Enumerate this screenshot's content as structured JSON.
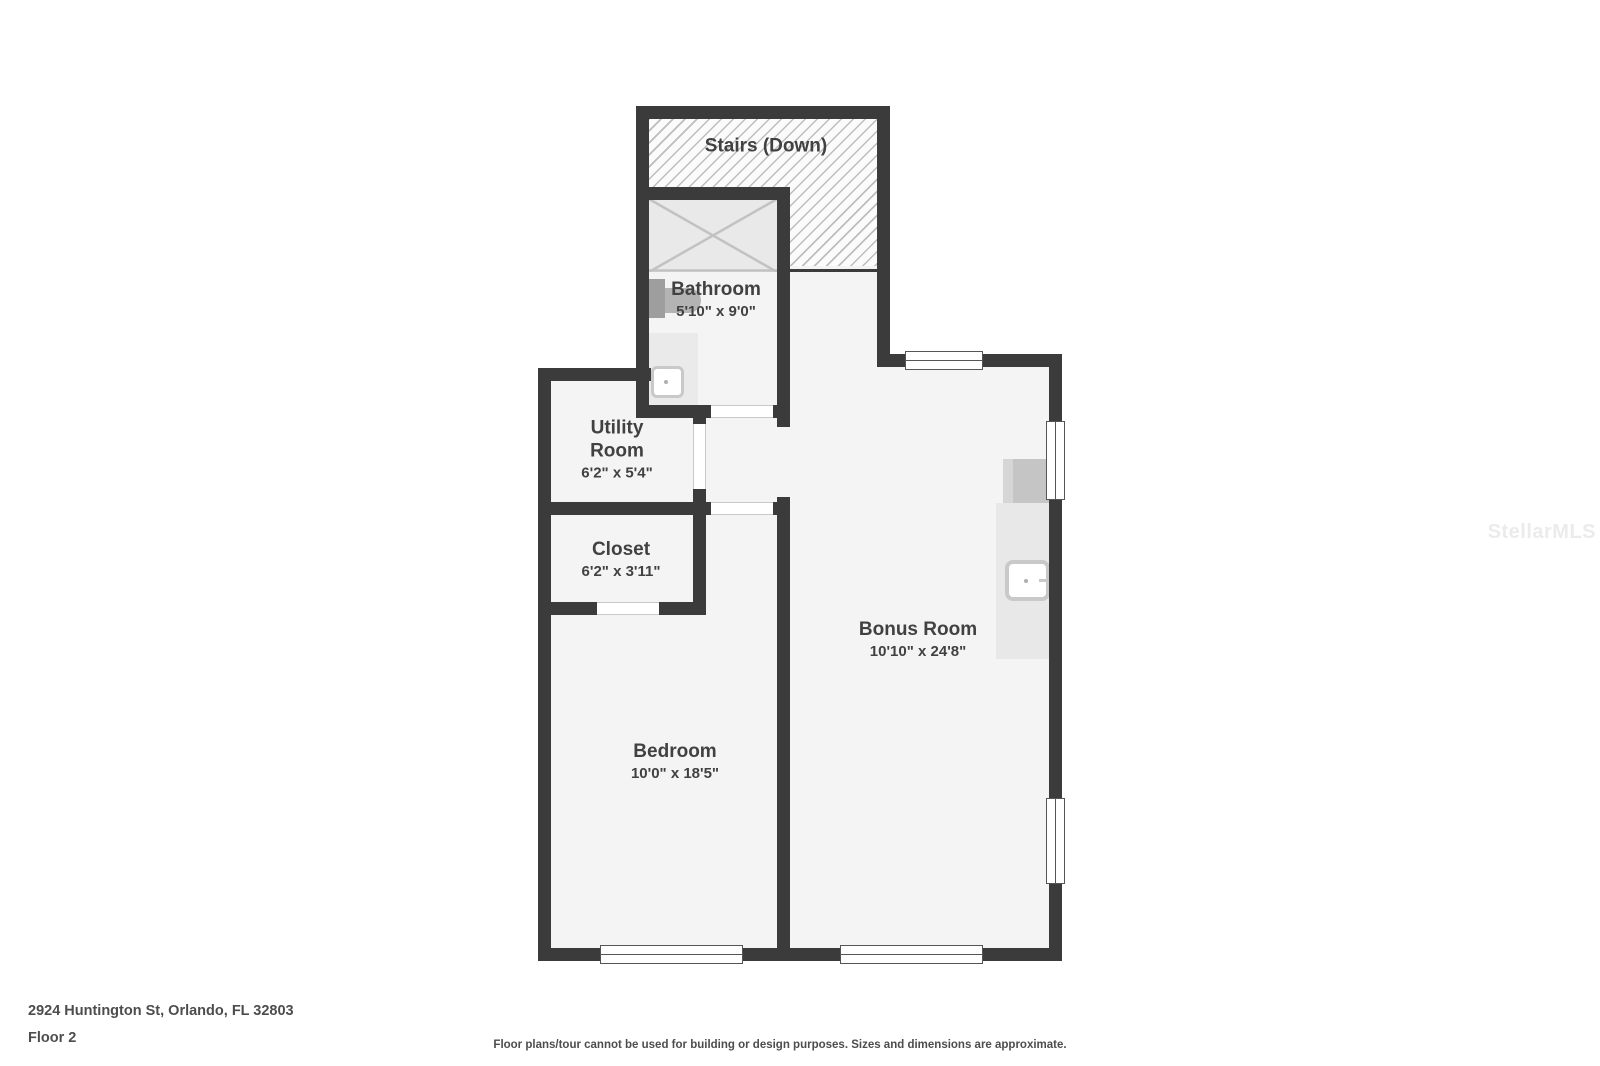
{
  "rooms": {
    "stairs": {
      "label": "Stairs (Down)"
    },
    "bathroom": {
      "label": "Bathroom",
      "dims": "5'10\" x 9'0\""
    },
    "utility": {
      "line1": "Utility",
      "line2": "Room",
      "dims": "6'2\" x 5'4\""
    },
    "closet": {
      "label": "Closet",
      "dims": "6'2\" x 3'11\""
    },
    "bedroom": {
      "label": "Bedroom",
      "dims": "10'0\" x 18'5\""
    },
    "bonus": {
      "label": "Bonus Room",
      "dims": "10'10\" x 24'8\""
    }
  },
  "footer": {
    "address": "2924 Huntington St, Orlando, FL 32803",
    "floor": "Floor 2",
    "disclaimer": "Floor plans/tour cannot be used for building or design purposes. Sizes and dimensions are approximate."
  },
  "watermark": "StellarMLS",
  "colors": {
    "wall": "#3b3b3b",
    "floor": "#f4f4f4",
    "hatch_line": "#bdbdbd",
    "label_text": "#414141",
    "fixture_gray": "#c5c5c5",
    "footer_text": "#4d4d4d"
  }
}
